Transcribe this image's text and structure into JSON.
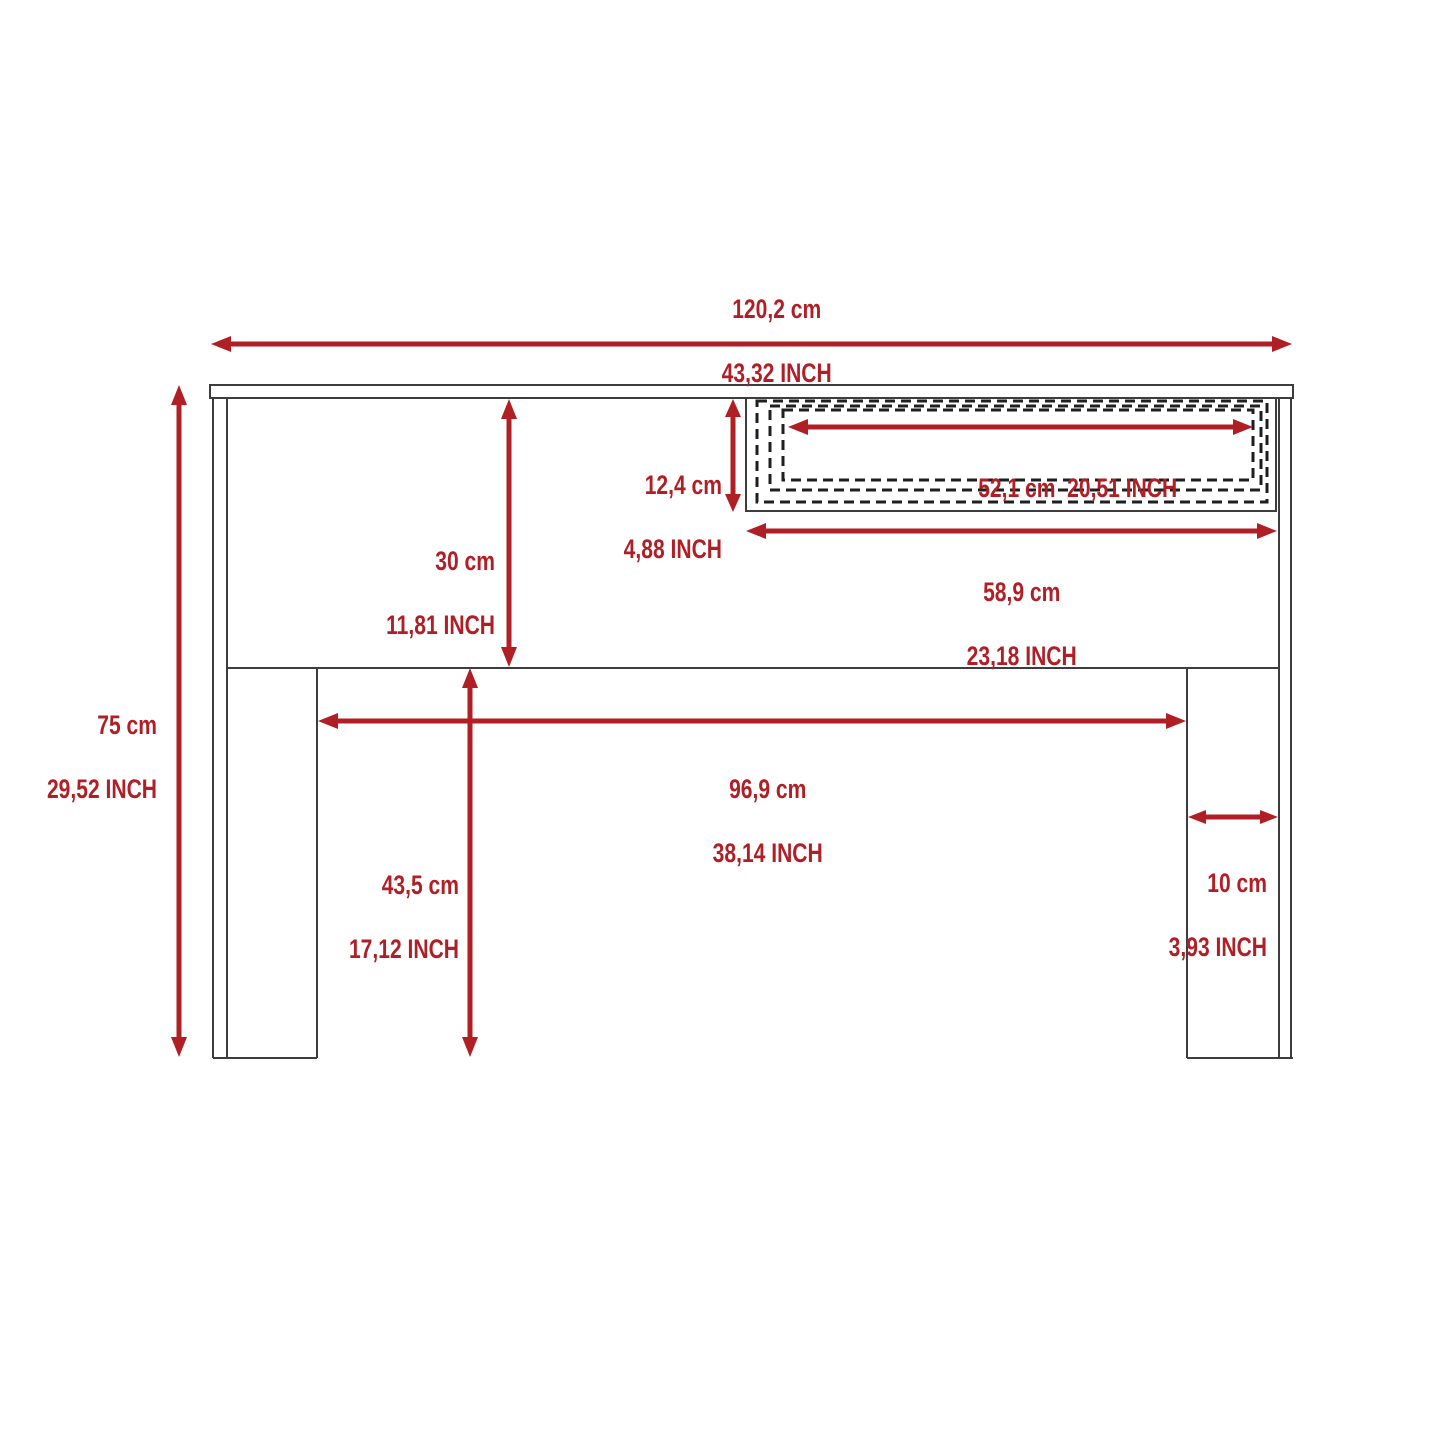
{
  "diagram": {
    "type": "furniture-dimension-drawing",
    "subject": "desk with drawer, front elevation",
    "colors": {
      "red": "#B01F26",
      "outline": "#3D3D3D",
      "dashed": "#1F1F1F",
      "background": "#FFFFFF"
    },
    "labels": {
      "overall_width": {
        "cm": "120,2 cm",
        "inch": "43,32 INCH"
      },
      "overall_height": {
        "cm": "75 cm",
        "inch": "29,52 INCH"
      },
      "drawer_front_height": {
        "cm": "12,4 cm",
        "inch": "4,88 INCH"
      },
      "drawer_inner_width": {
        "line": "52,1 cm  20,51 INCH"
      },
      "top_section_height": {
        "cm": "30 cm",
        "inch": "11,81 INCH"
      },
      "drawer_opening_width": {
        "cm": "58,9 cm",
        "inch": "23,18 INCH"
      },
      "space_between_legs": {
        "cm": "96,9 cm",
        "inch": "38,14 INCH"
      },
      "leg_height": {
        "cm": "43,5 cm",
        "inch": "17,12 INCH"
      },
      "leg_width": {
        "cm": "10 cm",
        "inch": "3,93 INCH"
      }
    }
  }
}
